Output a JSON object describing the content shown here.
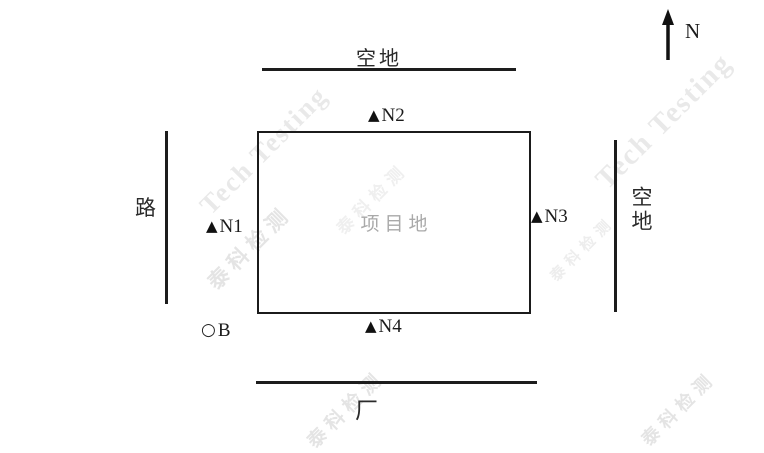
{
  "diagram": {
    "compass": {
      "label": "N"
    },
    "site": {
      "label": "项目地"
    },
    "surroundings": {
      "top": "空地",
      "left": "路",
      "right": "空地",
      "bottom": "厂"
    },
    "markers": {
      "n1": {
        "symbol": "▲",
        "label": "N1"
      },
      "n2": {
        "symbol": "▲",
        "label": "N2"
      },
      "n3": {
        "symbol": "▲",
        "label": "N3"
      },
      "n4": {
        "symbol": "▲",
        "label": "N4"
      },
      "b": {
        "symbol": "○",
        "label": "B"
      }
    }
  },
  "watermark": {
    "en": "Tech Testing",
    "zh": "泰科检测"
  },
  "colors": {
    "line": "#1d1d1d",
    "marker": "#111111",
    "site_label": "#a9a9a9",
    "watermark_en": "#e9e9e9",
    "watermark_zh": "#e4e4e4",
    "background": "#ffffff"
  }
}
